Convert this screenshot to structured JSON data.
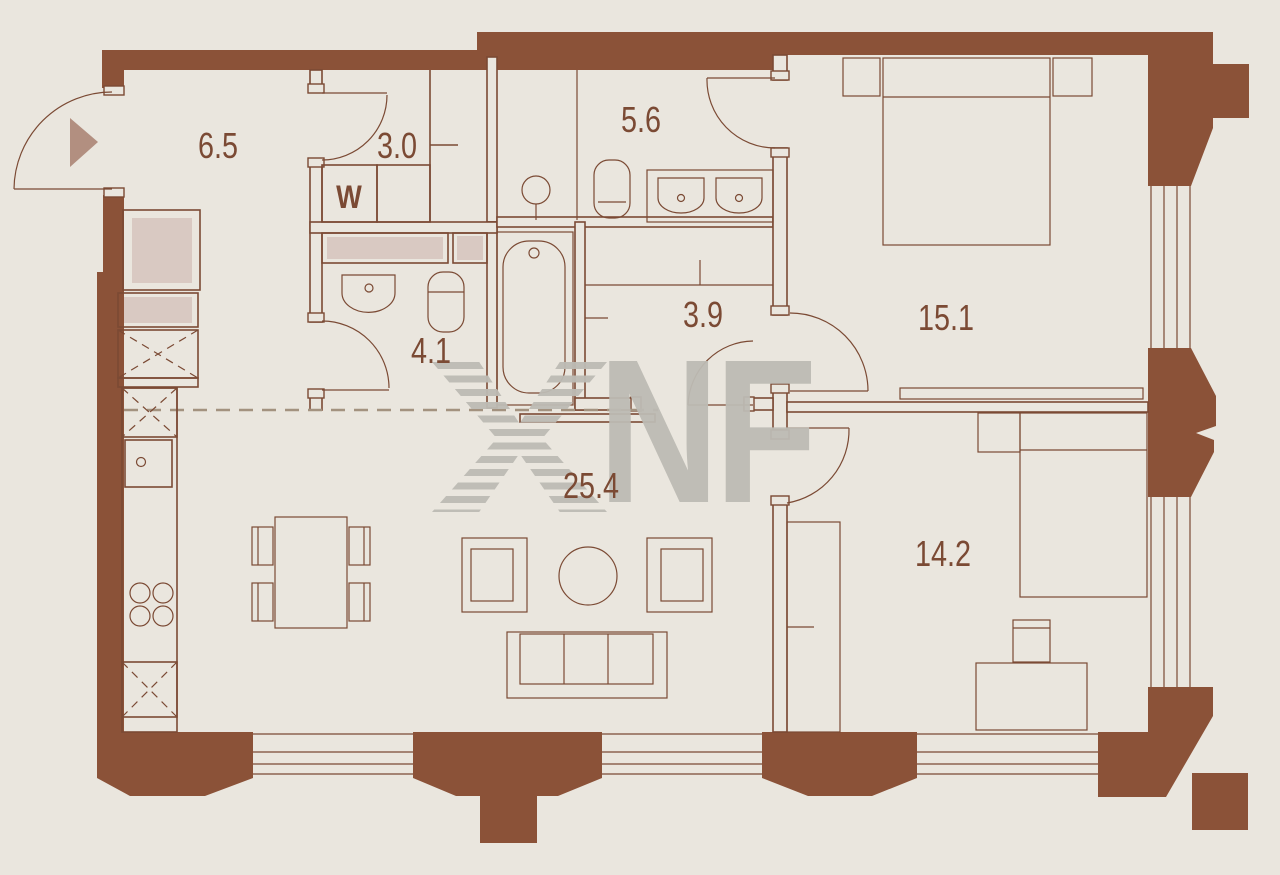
{
  "title": "apartment floor plan",
  "watermark": {
    "symbol": "striped-x-monogram",
    "letters": "NF"
  },
  "colors": {
    "bg": "#EAE6DE",
    "wall": "#8B5238",
    "line": "#7B4A34",
    "accent-fill": "#D9C9C2",
    "arrow": "#B28F80",
    "watermark": "#BDBBB4",
    "dash": "#A3927F"
  },
  "rooms": [
    {
      "name": "hallway",
      "area_m2": "6.5"
    },
    {
      "name": "laundry",
      "area_m2": "3.0",
      "appliance": "W"
    },
    {
      "name": "master-bathroom",
      "area_m2": "5.6"
    },
    {
      "name": "guest-bathroom",
      "area_m2": "4.1"
    },
    {
      "name": "walk-in-closet",
      "area_m2": "3.9"
    },
    {
      "name": "master-bedroom",
      "area_m2": "15.1"
    },
    {
      "name": "living-kitchen",
      "area_m2": "25.4"
    },
    {
      "name": "bedroom",
      "area_m2": "14.2"
    }
  ]
}
